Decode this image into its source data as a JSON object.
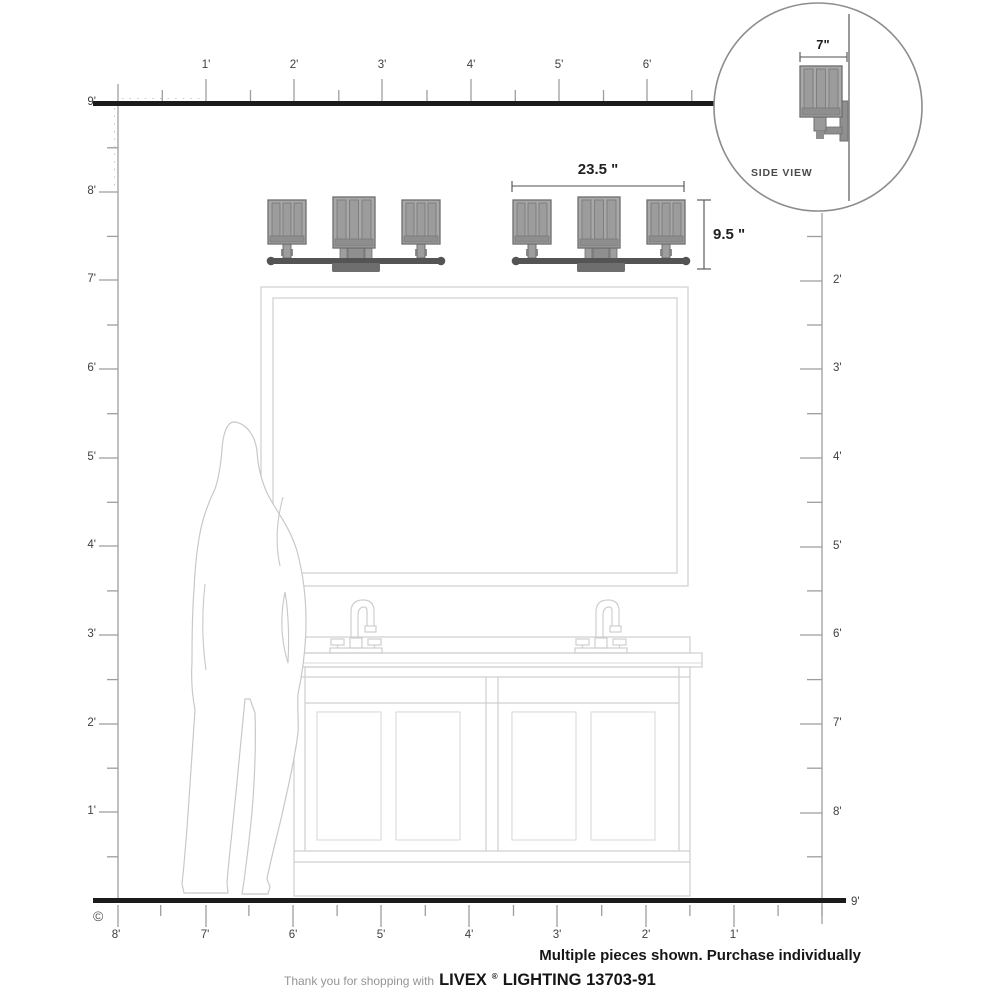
{
  "rulers": {
    "top": {
      "labels": [
        "1'",
        "2'",
        "3'",
        "4'",
        "5'",
        "6'"
      ]
    },
    "left": {
      "labels": [
        "9'",
        "8'",
        "7'",
        "6'",
        "5'",
        "4'",
        "3'",
        "2'",
        "1'"
      ]
    },
    "right": {
      "labels": [
        "2'",
        "3'",
        "4'",
        "5'",
        "6'",
        "7'",
        "8'"
      ]
    },
    "bottom": {
      "labels": [
        "8'",
        "7'",
        "6'",
        "5'",
        "4'",
        "3'",
        "2'",
        "1'"
      ],
      "end_label": "9'"
    }
  },
  "dimensions": {
    "fixture_width": "23.5 \"",
    "fixture_height": "9.5 \"",
    "fixture_depth": "7\""
  },
  "inset": {
    "caption": "SIDE VIEW"
  },
  "notes": {
    "purchase": "Multiple pieces shown. Purchase individually"
  },
  "footer": {
    "thanks": "Thank you for shopping with",
    "brand": "LIVEX",
    "registered": "®",
    "product": "LIGHTING 13703-91"
  },
  "copyright_mark": "©",
  "colors": {
    "heavy_line": "#1b1b1b",
    "ruler_line": "#9e9e9e",
    "drawing_line": "#cfcfcf",
    "fixture_shade": "#a8a8a8",
    "fixture_bar": "#545454",
    "dimension_text": "#1f1f1f"
  }
}
